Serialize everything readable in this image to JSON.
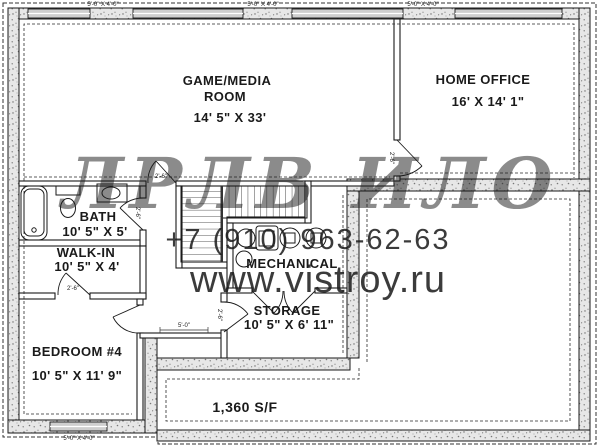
{
  "plan": {
    "title": "basement-floor-plan",
    "rooms": {
      "game": {
        "line1": "GAME/MEDIA",
        "line2": "ROOM",
        "dims": "14' 5\" X 33'"
      },
      "office": {
        "line1": "HOME OFFICE",
        "dims": "16' X 14' 1\""
      },
      "bath": {
        "line1": "BATH",
        "dims": "10' 5\" X 5'"
      },
      "walkin": {
        "line1": "WALK-IN",
        "dims": "10' 5\" X 4'"
      },
      "mechanical": {
        "line1": "MECHANICAL"
      },
      "storage": {
        "line1": "STORAGE",
        "dims": "10' 5\" X 6' 11\""
      },
      "bedroom": {
        "line1": "BEDROOM #4",
        "dims": "10' 5\" X 11' 9\""
      }
    },
    "area_label": "1,360 S/F",
    "dimensions": {
      "window_top": "5'-0\" X 4'-0\"",
      "window_bottom": "5'-0\" X 4'-0\"",
      "hall": "5'-0\"",
      "door": "2'-6\""
    }
  },
  "watermark": {
    "logo": "ЛРЛВ ИЛО",
    "phone": "+7 (910) 963-62-63",
    "site": "www.vistroy.ru"
  },
  "colors": {
    "wall_fill": "#e7e7e7",
    "line": "#1a1a1a",
    "watermark_logo": "#7d7d7d",
    "watermark_phone": "#b0b0b0",
    "watermark_site": "#bdbdbd"
  }
}
